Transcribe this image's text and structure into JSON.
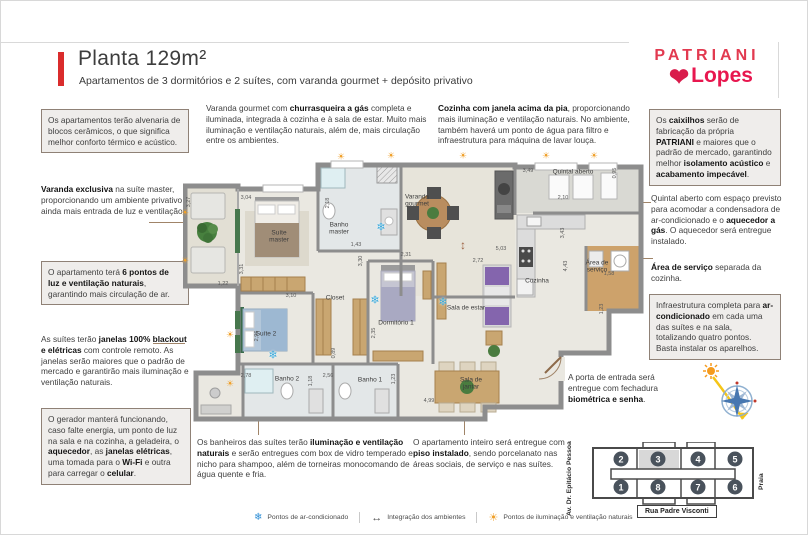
{
  "header": {
    "title": "Planta 129m²",
    "subtitle": "Apartamentos de 3 dormitórios e 2 suítes, com varanda gourmet + depósito privativo",
    "brand_primary": "PATRIANI",
    "brand_secondary": "Lopes",
    "accent_color": "#da2c2c",
    "brand_color": "#e8174f"
  },
  "notes": [
    {
      "name": "left-alvenaria",
      "x": 40,
      "y": 108,
      "w": 148,
      "boxed": true,
      "text": "Os apartamentos terão alvenaria de blocos cerâmicos, o que significa melhor conforto térmico e acústico."
    },
    {
      "name": "left-varanda-exclusiva",
      "x": 40,
      "y": 183,
      "w": 150,
      "boxed": false,
      "text": "**Varanda exclusiva** na suíte master, proporcionando um ambiente privativo e ainda mais entrada de luz e ventilação."
    },
    {
      "name": "left-pontos-de-luz",
      "x": 40,
      "y": 260,
      "w": 148,
      "boxed": true,
      "text": "O apartamento terá **6 pontos de luz e ventilação naturais**, garantindo mais circulação de ar."
    },
    {
      "name": "left-janelas-blackout",
      "x": 40,
      "y": 333,
      "w": 150,
      "boxed": false,
      "text": "As suítes terão **janelas 100% blackout e elétricas** com controle remoto. As janelas serão maiores que o padrão de mercado e garantirão mais iluminação e ventilação naturais."
    },
    {
      "name": "left-gerador",
      "x": 40,
      "y": 407,
      "w": 150,
      "boxed": true,
      "text": "O gerador manterá funcionando, caso falte energia, um ponto de luz na sala e na cozinha, a geladeira, o **aquecedor**, as **janelas elétricas**, uma tomada para o **Wi-Fi** e outra para carregar o **celular**."
    },
    {
      "name": "top-varanda-gourmet",
      "x": 205,
      "y": 102,
      "w": 228,
      "boxed": false,
      "text": "Varanda gourmet com **churrasqueira a gás** completa e iluminada, integrada à cozinha e à sala de estar. Muito mais iluminação e ventilação naturais, além de, mais circulação entre os ambientes."
    },
    {
      "name": "top-cozinha",
      "x": 437,
      "y": 102,
      "w": 208,
      "boxed": false,
      "text": "**Cozinha com janela acima da pia**, proporcionando mais iluminação e ventilação naturais. No ambiente, também haverá um ponto de água para filtro e infraestrutura para máquina de lavar louça."
    },
    {
      "name": "right-caixilhos",
      "x": 648,
      "y": 108,
      "w": 132,
      "boxed": true,
      "text": "Os **caixilhos** serão de fabricação da própria **PATRIANI** e maiores que o padrão de mercado, garantindo melhor **isolamento acústico** e **acabamento impecável**."
    },
    {
      "name": "right-quintal",
      "x": 650,
      "y": 192,
      "w": 132,
      "boxed": false,
      "text": "Quintal aberto com espaço previsto para acomodar a condensadora de ar-condicionado e o **aquecedor a gás**. O aquecedor será entregue instalado."
    },
    {
      "name": "right-area-servico",
      "x": 650,
      "y": 261,
      "w": 132,
      "boxed": false,
      "text": "**Área de serviço** separada da cozinha."
    },
    {
      "name": "right-infra-ar",
      "x": 648,
      "y": 293,
      "w": 132,
      "boxed": true,
      "text": "Infraestrutura completa para **ar-condicionado** em cada uma das suítes e na sala, totalizando quatro pontos. Basta instalar os aparelhos."
    },
    {
      "name": "bottom-banheiros",
      "x": 196,
      "y": 436,
      "w": 232,
      "boxed": false,
      "text": "Os banheiros das suítes terão **iluminação e ventilação naturais** e serão entregues com box de vidro temperado e nicho para shampoo, além de torneiras monocomando de água quente e fria."
    },
    {
      "name": "bottom-piso",
      "x": 412,
      "y": 436,
      "w": 165,
      "boxed": false,
      "text": "O apartamento inteiro será entregue com **piso instalado**, sendo porcelanato nas áreas sociais, de serviço e nas suítes."
    },
    {
      "name": "bottom-porta",
      "x": 567,
      "y": 371,
      "w": 112,
      "boxed": false,
      "text": "A porta de entrada será entregue com fechadura **biométrica e senha**."
    }
  ],
  "connectors": [
    {
      "x": 148,
      "y": 221,
      "w": 36,
      "h": 1
    },
    {
      "x": 152,
      "y": 342,
      "w": 32,
      "h": 1
    },
    {
      "x": 630,
      "y": 201,
      "w": 20,
      "h": 1
    },
    {
      "x": 632,
      "y": 257,
      "w": 20,
      "h": 1
    },
    {
      "x": 512,
      "y": 377,
      "w": 52,
      "h": 1
    },
    {
      "x": 257,
      "y": 392,
      "w": 1,
      "h": 42
    },
    {
      "x": 463,
      "y": 370,
      "w": 1,
      "h": 64
    }
  ],
  "plan": {
    "labels": [
      {
        "name": "suite-master",
        "t": "Suíte\nmaster",
        "x": 96,
        "y": 86
      },
      {
        "name": "banho-master",
        "t": "Banho\nmaster",
        "x": 156,
        "y": 78
      },
      {
        "name": "varanda-gourmet",
        "t": "Varanda\ngourmet",
        "x": 234,
        "y": 50
      },
      {
        "name": "quintal-aberto",
        "t": "Quintal aberto",
        "x": 390,
        "y": 21
      },
      {
        "name": "cozinha",
        "t": "Cozinha",
        "x": 354,
        "y": 130
      },
      {
        "name": "area-servico",
        "t": "Área de\nserviço",
        "x": 414,
        "y": 116
      },
      {
        "name": "closet",
        "t": "Closet",
        "x": 152,
        "y": 147
      },
      {
        "name": "dormitorio-1",
        "t": "Dormitório 1",
        "x": 213,
        "y": 172
      },
      {
        "name": "suite-2",
        "t": "Suíte 2",
        "x": 83,
        "y": 183
      },
      {
        "name": "banho-2",
        "t": "Banho 2",
        "x": 104,
        "y": 228
      },
      {
        "name": "banho-1",
        "t": "Banho 1",
        "x": 187,
        "y": 229
      },
      {
        "name": "sala-de-estar",
        "t": "Sala de estar",
        "x": 283,
        "y": 157
      },
      {
        "name": "sala-de-jantar",
        "t": "Sala de\njantar",
        "x": 288,
        "y": 233
      }
    ],
    "dims": [
      {
        "v": "3,04",
        "x": 63,
        "y": 47
      },
      {
        "v": "3,27",
        "x": 6,
        "y": 51,
        "r": 1
      },
      {
        "v": "1,22",
        "x": 40,
        "y": 133
      },
      {
        "v": "3,31",
        "x": 59,
        "y": 118,
        "r": 1
      },
      {
        "v": "2,18",
        "x": 145,
        "y": 52,
        "r": 1
      },
      {
        "v": "1,43",
        "x": 173,
        "y": 94
      },
      {
        "v": "3,49",
        "x": 345,
        "y": 20
      },
      {
        "v": "0,95",
        "x": 432,
        "y": 22,
        "r": 1
      },
      {
        "v": "2,10",
        "x": 380,
        "y": 47
      },
      {
        "v": "3,43",
        "x": 380,
        "y": 82,
        "r": 1
      },
      {
        "v": "4,43",
        "x": 383,
        "y": 115,
        "r": 1
      },
      {
        "v": "1,58",
        "x": 426,
        "y": 123
      },
      {
        "v": "1,23",
        "x": 419,
        "y": 158,
        "r": 1
      },
      {
        "v": "5,03",
        "x": 318,
        "y": 98
      },
      {
        "v": "2,72",
        "x": 295,
        "y": 110
      },
      {
        "v": "2,31",
        "x": 223,
        "y": 104
      },
      {
        "v": "2,35",
        "x": 191,
        "y": 182,
        "r": 1
      },
      {
        "v": "0,89",
        "x": 151,
        "y": 202,
        "r": 1
      },
      {
        "v": "3,30",
        "x": 178,
        "y": 110,
        "r": 1
      },
      {
        "v": "3,10",
        "x": 108,
        "y": 145
      },
      {
        "v": "2,96",
        "x": 74,
        "y": 185,
        "r": 1
      },
      {
        "v": "2,78",
        "x": 63,
        "y": 225
      },
      {
        "v": "1,18",
        "x": 128,
        "y": 230,
        "r": 1
      },
      {
        "v": "2,56",
        "x": 145,
        "y": 225
      },
      {
        "v": "1,23",
        "x": 211,
        "y": 228,
        "r": 1
      },
      {
        "v": "4,99",
        "x": 246,
        "y": 250
      }
    ],
    "icons": [
      {
        "type": "ac",
        "x": 198,
        "y": 77
      },
      {
        "type": "ac",
        "x": 90,
        "y": 205
      },
      {
        "type": "ac",
        "x": 192,
        "y": 150
      },
      {
        "type": "ac",
        "x": 260,
        "y": 152
      },
      {
        "type": "sun",
        "x": 158,
        "y": 6
      },
      {
        "type": "sun",
        "x": 208,
        "y": 5
      },
      {
        "type": "sun",
        "x": 280,
        "y": 5
      },
      {
        "type": "sun",
        "x": 363,
        "y": 5
      },
      {
        "type": "sun",
        "x": 411,
        "y": 5
      },
      {
        "type": "sun",
        "x": 2,
        "y": 62
      },
      {
        "type": "sun",
        "x": 2,
        "y": 110
      },
      {
        "type": "sun",
        "x": 47,
        "y": 184
      },
      {
        "type": "sun",
        "x": 47,
        "y": 233
      },
      {
        "type": "int",
        "x": 280,
        "y": 94
      }
    ]
  },
  "legend": {
    "items": [
      {
        "icon": "ac",
        "label": "Pontos de ar-condicionado"
      },
      {
        "icon": "int",
        "label": "Integração dos ambientes"
      },
      {
        "icon": "sun",
        "label": "Pontos de iluminação e ventilação naturais"
      }
    ],
    "colors": {
      "ac": "#2f8fd6",
      "sun": "#f0a02a",
      "integration": "#9c5f3f"
    }
  },
  "minimap": {
    "units": [
      {
        "n": "2",
        "x": 30,
        "y": 17
      },
      {
        "n": "3",
        "x": 67,
        "y": 17,
        "hl": true
      },
      {
        "n": "4",
        "x": 107,
        "y": 17
      },
      {
        "n": "5",
        "x": 144,
        "y": 17
      },
      {
        "n": "1",
        "x": 30,
        "y": 45
      },
      {
        "n": "8",
        "x": 67,
        "y": 45
      },
      {
        "n": "7",
        "x": 107,
        "y": 45
      },
      {
        "n": "6",
        "x": 144,
        "y": 45
      }
    ],
    "street_left": "Av. Dr. Epitácio Pessoa",
    "street_right": "Praia",
    "street_bottom": "Rua Padre Visconti"
  }
}
